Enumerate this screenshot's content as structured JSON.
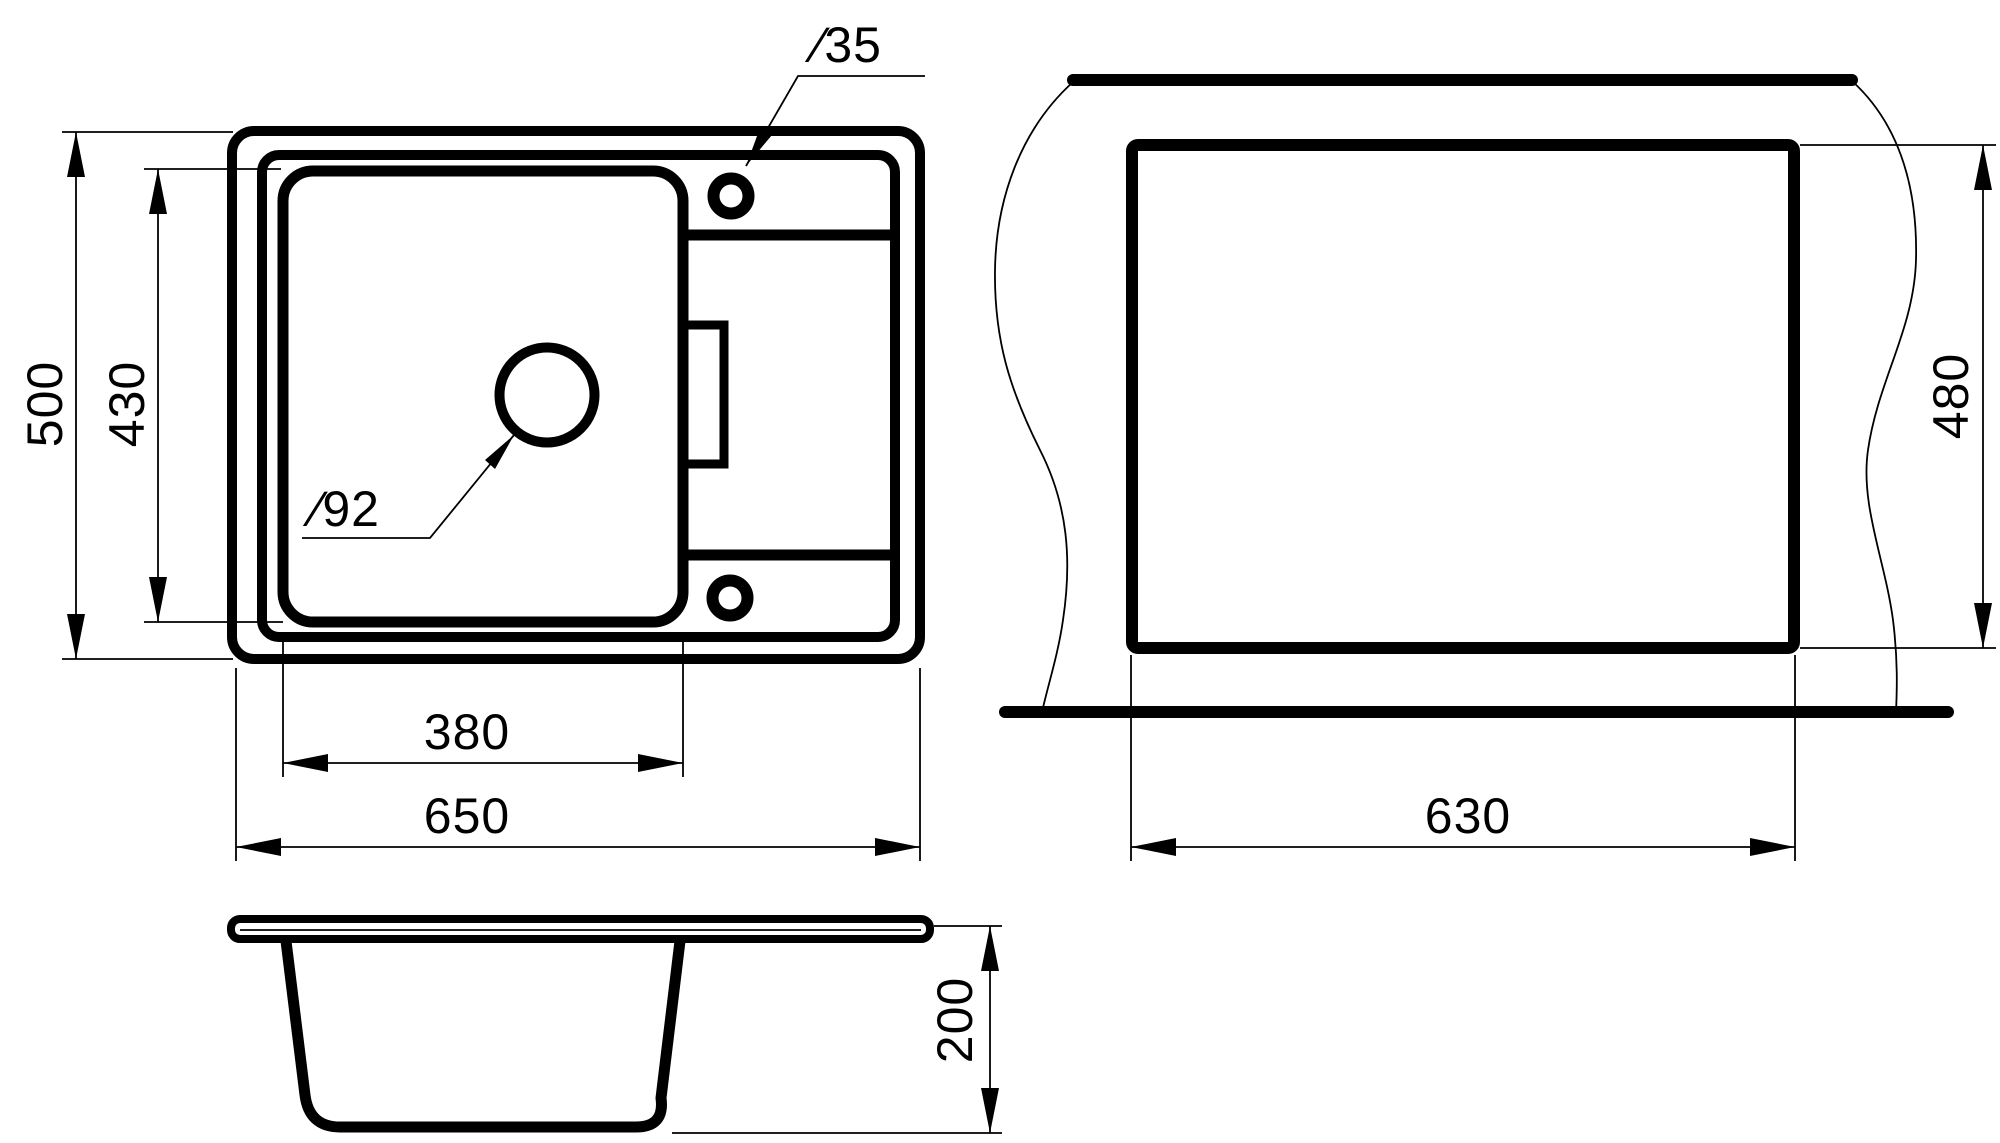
{
  "drawing": {
    "title": "kitchen-sink-dimension-drawing",
    "line_color": "#000000",
    "background": "#ffffff",
    "views": {
      "top_view": "sink-top-view",
      "cutout_view": "countertop-cutout-view",
      "side_view": "sink-side-section-view"
    },
    "labels": {
      "height_total": "500",
      "height_bowl": "430",
      "faucet_diameter": "∕35",
      "drain_diameter": "∕92",
      "width_bowl": "380",
      "width_total": "650",
      "cutout_width": "630",
      "cutout_height": "480",
      "depth": "200"
    },
    "dimensions_mm": {
      "overall_width": 650,
      "overall_depth": 500,
      "bowl_width": 380,
      "bowl_depth": 430,
      "drain_hole_diameter": 92,
      "faucet_hole_diameter": 35,
      "cutout_width": 630,
      "cutout_depth": 480,
      "bowl_height": 200
    }
  }
}
